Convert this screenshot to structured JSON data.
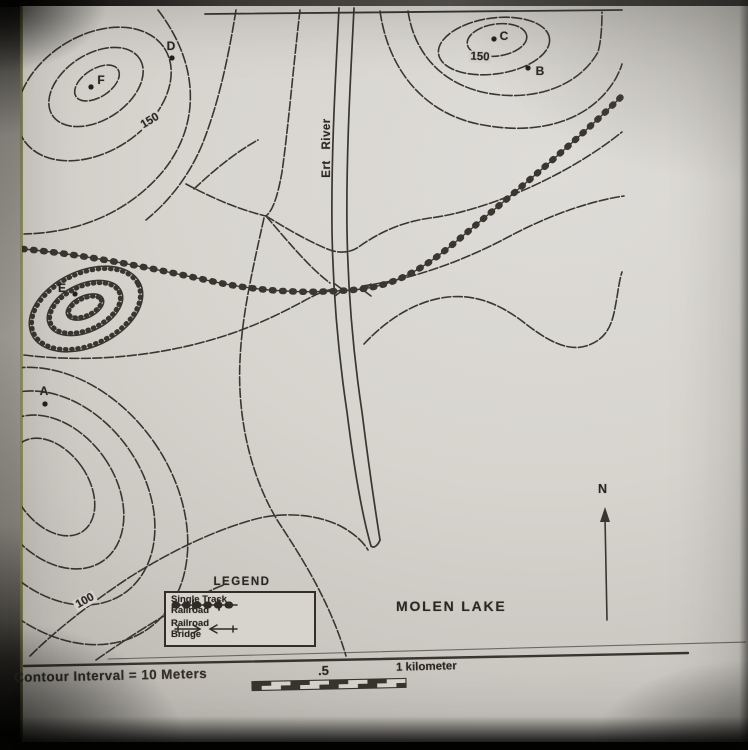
{
  "photo": {
    "paper_color": "#d7d4ce",
    "ink_color": "#2e2a24",
    "page_edge_color": "#8f905e"
  },
  "map": {
    "title": "MOLEN LAKE",
    "river_label": "Ert River",
    "north_label": "N",
    "points": [
      {
        "label": "A",
        "x": 45,
        "y": 404,
        "label_x": 44,
        "label_y": 391
      },
      {
        "label": "B",
        "x": 528,
        "y": 68,
        "label_x": 540,
        "label_y": 71
      },
      {
        "label": "C",
        "x": 494,
        "y": 39,
        "label_x": 504,
        "label_y": 36
      },
      {
        "label": "D",
        "x": 172,
        "y": 58,
        "label_x": 171,
        "label_y": 46
      },
      {
        "label": "E",
        "x": 75,
        "y": 294,
        "label_x": 62,
        "label_y": 288
      },
      {
        "label": "F",
        "x": 91,
        "y": 87,
        "label_x": 101,
        "label_y": 80
      }
    ],
    "contour_labels": [
      {
        "text": "150",
        "x": 150,
        "y": 121,
        "rotate": -31
      },
      {
        "text": "150",
        "x": 480,
        "y": 57,
        "rotate": 3
      },
      {
        "text": "100",
        "x": 85,
        "y": 601,
        "rotate": -29
      }
    ]
  },
  "legend": {
    "title": "LEGEND",
    "items": [
      {
        "line1": "Single Track",
        "line2": "Railroad",
        "symbol": "single-track-railroad-symbol"
      },
      {
        "line1": "Railroad",
        "line2": "Bridge",
        "symbol": "railroad-bridge-symbol"
      }
    ]
  },
  "scale": {
    "contour_interval_text": "Contour Interval = 10 Meters",
    "half_label": ".5",
    "full_label": "1 kilometer"
  }
}
